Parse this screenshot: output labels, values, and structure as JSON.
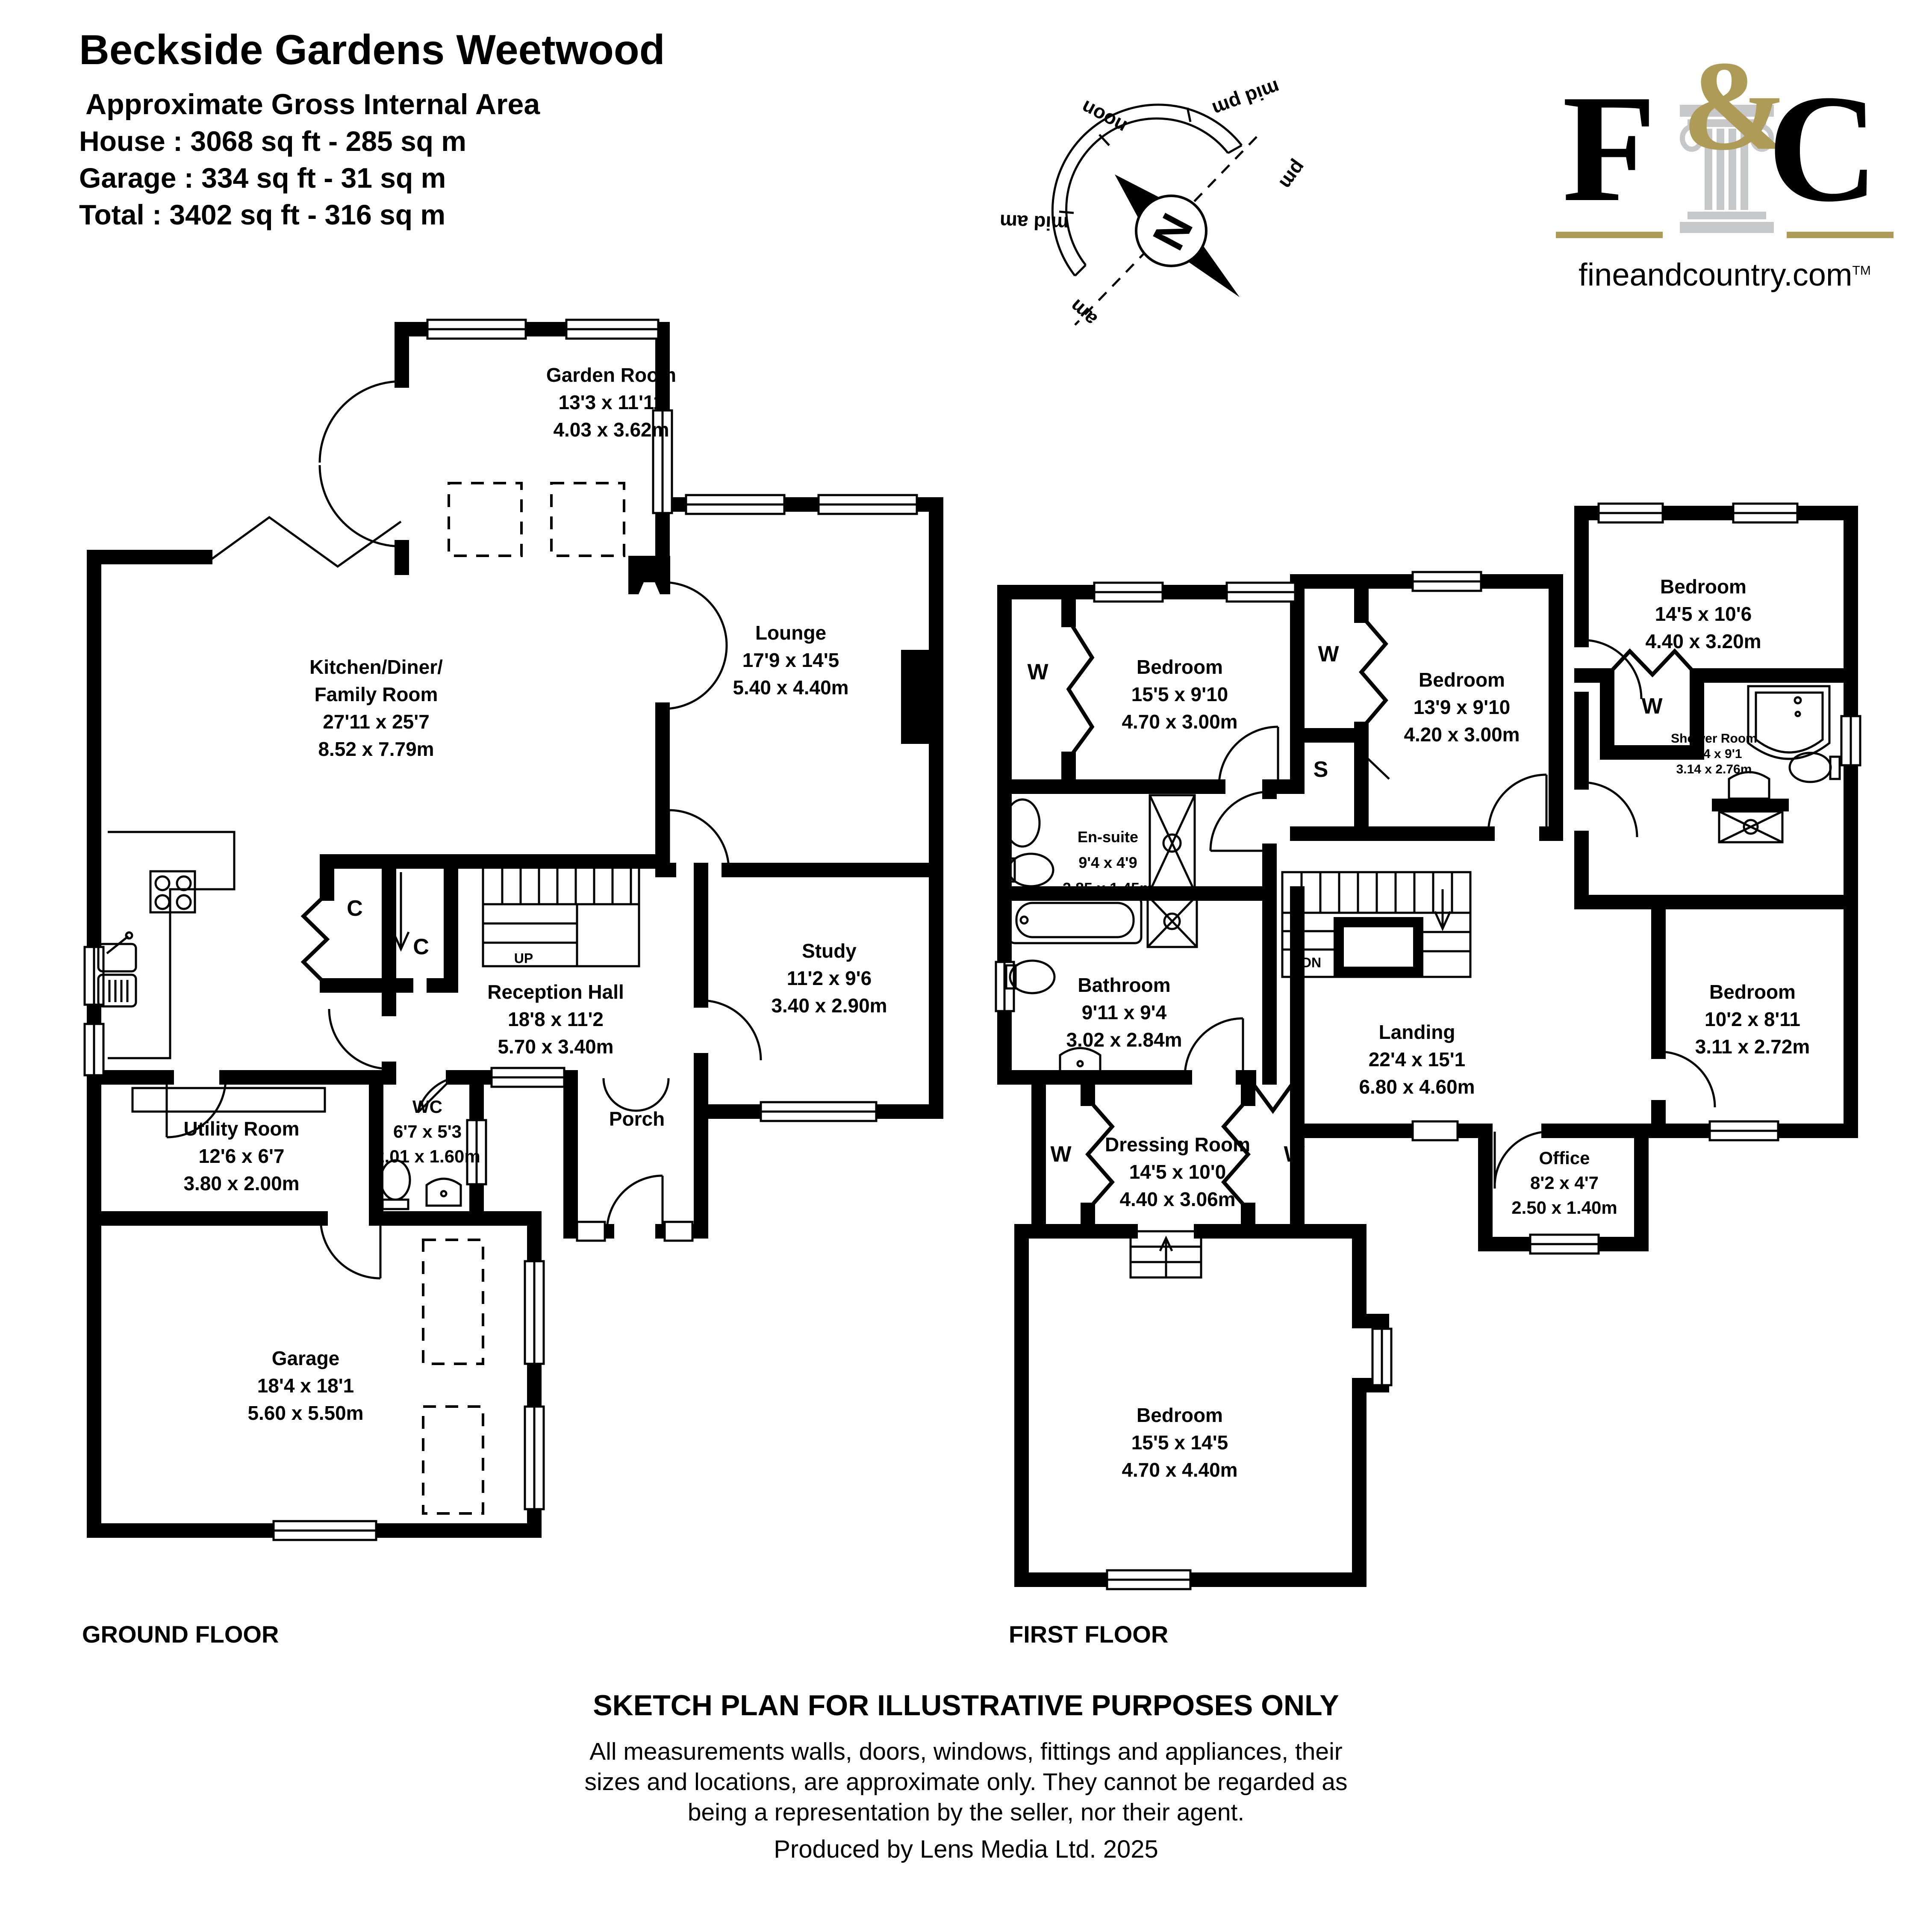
{
  "header": {
    "title": "Beckside Gardens Weetwood",
    "subtitle": "Approximate Gross Internal Area",
    "house": "House : 3068 sq ft - 285 sq m",
    "garage": "Garage : 334 sq ft - 31 sq m",
    "total": "Total : 3402 sq ft - 316 sq m"
  },
  "compass": {
    "north": "N",
    "noon": "noon",
    "mid_pm": "mid pm",
    "pm": "pm",
    "mid_am": "mid am",
    "am": "am"
  },
  "logo": {
    "f": "F",
    "amp": "&",
    "c": "C",
    "site": "fineandcountry.com",
    "tm": "TM"
  },
  "ground": {
    "floor_label": "GROUND FLOOR",
    "rooms": {
      "garden": {
        "lines": [
          "Garden Room",
          "13'3 x 11'11",
          "4.03 x 3.62m"
        ]
      },
      "kitchen": {
        "lines": [
          "Kitchen/Diner/",
          "Family Room",
          "27'11 x 25'7",
          "8.52 x 7.79m"
        ]
      },
      "lounge": {
        "lines": [
          "Lounge",
          "17'9 x 14'5",
          "5.40 x 4.40m"
        ]
      },
      "study": {
        "lines": [
          "Study",
          "11'2 x 9'6",
          "3.40 x 2.90m"
        ]
      },
      "reception": {
        "lines": [
          "Reception Hall",
          "18'8 x 11'2",
          "5.70 x 3.40m"
        ]
      },
      "wc": {
        "lines": [
          "WC",
          "6'7 x 5'3",
          "2.01 x 1.60m"
        ]
      },
      "porch": {
        "lines": [
          "Porch"
        ]
      },
      "utility": {
        "lines": [
          "Utility Room",
          "12'6 x 6'7",
          "3.80 x 2.00m"
        ]
      },
      "garage": {
        "lines": [
          "Garage",
          "18'4 x 18'1",
          "5.60 x 5.50m"
        ]
      }
    },
    "markers": {
      "up": "UP",
      "c1": "C",
      "c2": "C"
    }
  },
  "first": {
    "floor_label": "FIRST FLOOR",
    "rooms": {
      "bedroom1": {
        "lines": [
          "Bedroom",
          "15'5 x 9'10",
          "4.70 x 3.00m"
        ]
      },
      "ensuite": {
        "lines": [
          "En-suite",
          "9'4 x 4'9",
          "2.85 x 1.45m"
        ]
      },
      "bathroom": {
        "lines": [
          "Bathroom",
          "9'11 x 9'4",
          "3.02 x 2.84m"
        ]
      },
      "bedroom2": {
        "lines": [
          "Bedroom",
          "13'9 x 9'10",
          "4.20 x 3.00m"
        ]
      },
      "bedroom3": {
        "lines": [
          "Bedroom",
          "14'5 x 10'6",
          "4.40 x 3.20m"
        ]
      },
      "shower": {
        "lines": [
          "Shower Room",
          "10'4 x 9'1",
          "3.14 x 2.76m"
        ]
      },
      "bedroom4": {
        "lines": [
          "Bedroom",
          "10'2 x 8'11",
          "3.11 x 2.72m"
        ]
      },
      "office": {
        "lines": [
          "Office",
          "8'2 x 4'7",
          "2.50 x 1.40m"
        ]
      },
      "landing": {
        "lines": [
          "Landing",
          "22'4 x 15'1",
          "6.80 x 4.60m"
        ]
      },
      "dressing": {
        "lines": [
          "Dressing Room",
          "14'5 x 10'0",
          "4.40 x 3.06m"
        ]
      },
      "bedroom5": {
        "lines": [
          "Bedroom",
          "15'5 x 14'5",
          "4.70 x 4.40m"
        ]
      }
    },
    "markers": {
      "dn": "DN",
      "w1": "W",
      "w2": "W",
      "w3": "W",
      "w4": "W",
      "w5": "W",
      "s": "S"
    }
  },
  "footer": {
    "sketch": "SKETCH PLAN FOR ILLUSTRATIVE PURPOSES ONLY",
    "disclaimer1": "All measurements walls, doors, windows, fittings and appliances, their",
    "disclaimer2": "sizes and locations, are approximate only. They cannot be regarded as",
    "disclaimer3": "being a representation by the seller, nor their agent.",
    "produced": "Produced by Lens Media Ltd. 2025"
  },
  "colors": {
    "ink": "#000000",
    "gold": "#AE9B57",
    "pillar": "#C6C7C9"
  }
}
